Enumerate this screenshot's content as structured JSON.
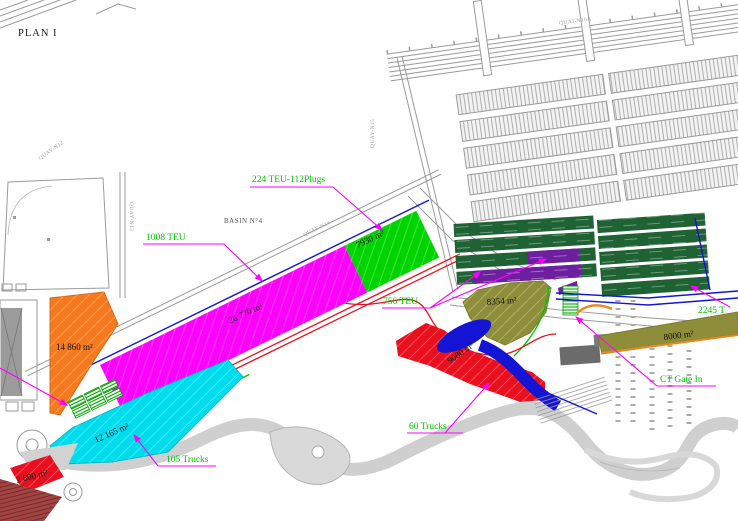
{
  "title": "PLAN I",
  "basin": {
    "label": "BASIN  N°4"
  },
  "quays": {
    "q12": "QUAY-N12",
    "q13": "QUAY-N13",
    "q14": "QUAY-N14",
    "q15": "QUAY-N15",
    "q16a": "QUAI-N16A"
  },
  "zones": {
    "magenta_terminal": {
      "area": "26 770 m²",
      "color": "#ff00ff"
    },
    "reefer_green": {
      "area": "7930 m²",
      "color": "#00d400"
    },
    "orange_yard": {
      "area": "14 860 m²",
      "color": "#f4791f"
    },
    "cyan_yard": {
      "area": "12 165 m²",
      "color": "#00dcec"
    },
    "red_ramp": {
      "area": "9080 m²",
      "color": "#e8101f"
    },
    "red_small": {
      "area": "2 800 m²",
      "color": "#e8101f"
    },
    "olive_east": {
      "area": "8354 m²",
      "color": "#8e8e3a"
    },
    "olive_band": {
      "area": "8000 m²",
      "color": "#8e8e3a"
    },
    "block_green": {
      "color": "#1f6233"
    },
    "block_purple": {
      "color": "#6d1fa0"
    }
  },
  "annotations": {
    "teu224": "224 TEU-112Plugs",
    "teu1008": "1008 TEU",
    "teu756": "756 TEU",
    "trucks105": "105 Trucks",
    "trucks60": "60 Trucks",
    "ct_gate_in": "CT Gate In",
    "teu2245": "2245 T"
  },
  "colors": {
    "annotation_green": "#00c400",
    "leader_magenta": "#ff00ff",
    "linework_gray": "#9a9a9a"
  }
}
